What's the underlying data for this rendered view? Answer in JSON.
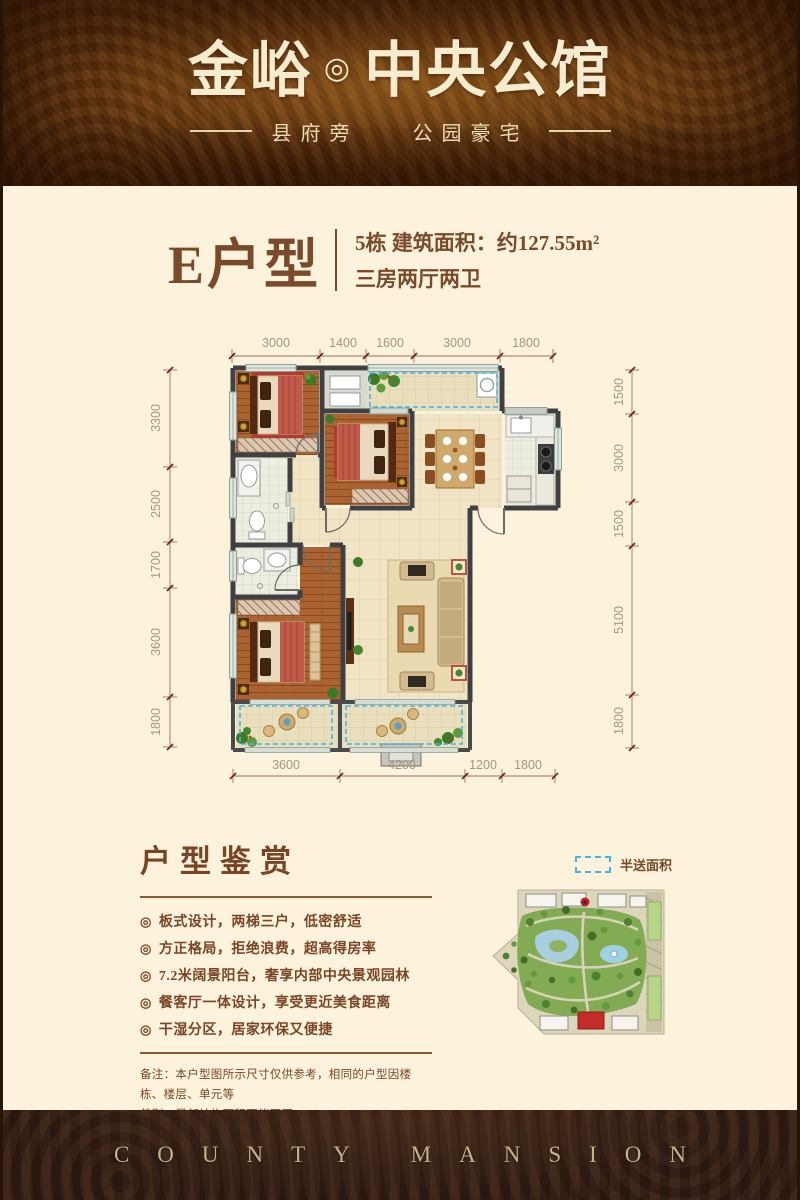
{
  "header": {
    "brand": "金峪",
    "mark": "◎",
    "name": "中央公馆",
    "tagline_left": "县府旁",
    "tagline_right": "公园豪宅"
  },
  "unit": {
    "title": "E户型",
    "line1": "5栋  建筑面积：约127.55m²",
    "line2": "三房两厅两卫"
  },
  "floorplan": {
    "dims_top": [
      "3000",
      "1400",
      "1600",
      "3000",
      "1800"
    ],
    "dims_left": [
      "3300",
      "2500",
      "1700",
      "3600",
      "1800"
    ],
    "dims_right": [
      "1500",
      "3000",
      "1500",
      "5100",
      "1800"
    ],
    "dims_bottom": [
      "3600",
      "4200",
      "1200",
      "1800"
    ]
  },
  "legend": {
    "label": "半送面积",
    "swatch_color": "#3fb6ea"
  },
  "appreciation": {
    "title": "户型鉴赏",
    "bullet_icon": "◎",
    "bullets": [
      "板式设计，两梯三户，低密舒适",
      "方正格局，拒绝浪费，超高得房率",
      "7.2米阔景阳台，奢享内部中央景观园林",
      "餐客厅一体设计，享受更近美食距离",
      "干湿分区，居家环保又便捷"
    ]
  },
  "note": {
    "line1": "备注：本户型图所示尺寸仅供参考，相同的户型因楼栋、楼层、单元等",
    "line2": "差别，局部结构面积可能不同"
  },
  "footer": {
    "text": "COUNTY MANSION"
  },
  "colors": {
    "header_bg": "#6b3a0f",
    "page_bg": "#fdf3dc",
    "accent_brown": "#7a4a2b",
    "dash_blue": "#3fb6ea",
    "footer_bg": "#352016",
    "footer_text": "#c5b18d"
  }
}
